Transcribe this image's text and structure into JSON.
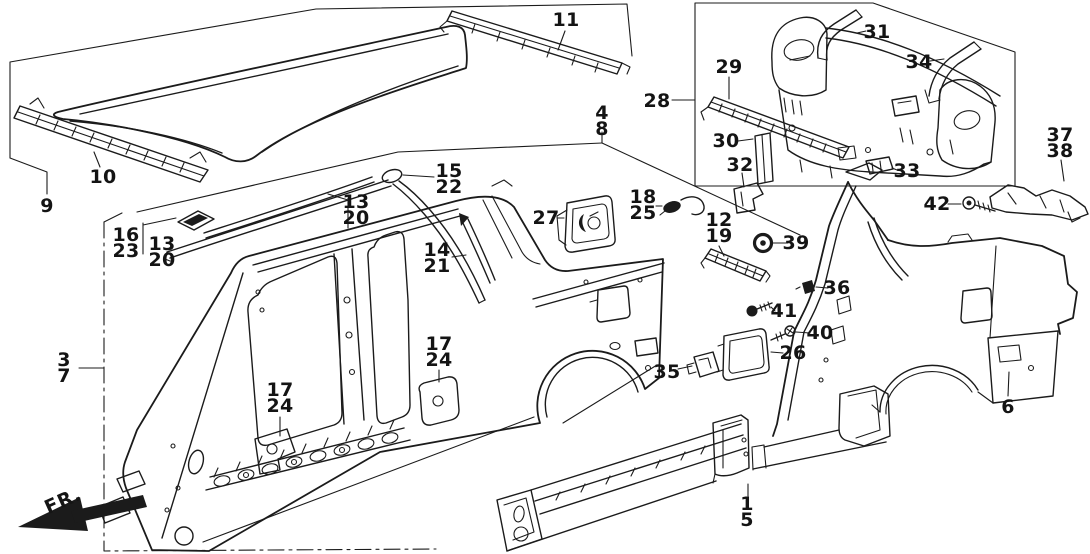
{
  "diagram": {
    "description": "Exploded line-art parts diagram of a car body outer shell: roof panel, roof rails and moldings, body side panel, rear bulkhead assembly, quarter panels, sill panels and small fasteners, with numbered part callouts.",
    "colors": {
      "background": "#ffffff",
      "line": "#1b1b1b"
    },
    "fr_indicator": {
      "label": "FR."
    },
    "callouts": [
      {
        "id": "9",
        "lines": [
          "9"
        ],
        "x": 47,
        "y": 206
      },
      {
        "id": "10",
        "lines": [
          "10"
        ],
        "x": 103,
        "y": 177
      },
      {
        "id": "16-23",
        "lines": [
          "16",
          "23"
        ],
        "x": 126,
        "y": 243
      },
      {
        "id": "13-20-a",
        "lines": [
          "13",
          "20"
        ],
        "x": 162,
        "y": 252
      },
      {
        "id": "13-20-b",
        "lines": [
          "13",
          "20"
        ],
        "x": 356,
        "y": 210
      },
      {
        "id": "15-22",
        "lines": [
          "15",
          "22"
        ],
        "x": 449,
        "y": 179
      },
      {
        "id": "14-21",
        "lines": [
          "14",
          "21"
        ],
        "x": 437,
        "y": 258
      },
      {
        "id": "27",
        "lines": [
          "27"
        ],
        "x": 546,
        "y": 218
      },
      {
        "id": "11",
        "lines": [
          "11"
        ],
        "x": 566,
        "y": 20
      },
      {
        "id": "4-8",
        "lines": [
          "4",
          "8"
        ],
        "x": 602,
        "y": 121
      },
      {
        "id": "28",
        "lines": [
          "28"
        ],
        "x": 657,
        "y": 101
      },
      {
        "id": "18-25",
        "lines": [
          "18",
          "25"
        ],
        "x": 643,
        "y": 205
      },
      {
        "id": "12-19",
        "lines": [
          "12",
          "19"
        ],
        "x": 719,
        "y": 228
      },
      {
        "id": "29",
        "lines": [
          "29"
        ],
        "x": 729,
        "y": 67
      },
      {
        "id": "30",
        "lines": [
          "30"
        ],
        "x": 726,
        "y": 141
      },
      {
        "id": "32",
        "lines": [
          "32"
        ],
        "x": 740,
        "y": 165
      },
      {
        "id": "31",
        "lines": [
          "31"
        ],
        "x": 877,
        "y": 32
      },
      {
        "id": "34",
        "lines": [
          "34"
        ],
        "x": 919,
        "y": 62
      },
      {
        "id": "33",
        "lines": [
          "33"
        ],
        "x": 907,
        "y": 171
      },
      {
        "id": "37-38",
        "lines": [
          "37",
          "38"
        ],
        "x": 1060,
        "y": 143
      },
      {
        "id": "42",
        "lines": [
          "42"
        ],
        "x": 937,
        "y": 204
      },
      {
        "id": "39",
        "lines": [
          "39"
        ],
        "x": 796,
        "y": 243
      },
      {
        "id": "36",
        "lines": [
          "36"
        ],
        "x": 837,
        "y": 288
      },
      {
        "id": "41",
        "lines": [
          "41"
        ],
        "x": 784,
        "y": 311
      },
      {
        "id": "40",
        "lines": [
          "40"
        ],
        "x": 820,
        "y": 333
      },
      {
        "id": "26",
        "lines": [
          "26"
        ],
        "x": 793,
        "y": 353
      },
      {
        "id": "35",
        "lines": [
          "35"
        ],
        "x": 667,
        "y": 372
      },
      {
        "id": "17-24-a",
        "lines": [
          "17",
          "24"
        ],
        "x": 280,
        "y": 398
      },
      {
        "id": "17-24-b",
        "lines": [
          "17",
          "24"
        ],
        "x": 439,
        "y": 352
      },
      {
        "id": "3-7",
        "lines": [
          "3",
          "7"
        ],
        "x": 64,
        "y": 368
      },
      {
        "id": "6",
        "lines": [
          "6"
        ],
        "x": 1008,
        "y": 407
      },
      {
        "id": "1-5",
        "lines": [
          "1",
          "5"
        ],
        "x": 747,
        "y": 512
      }
    ]
  }
}
